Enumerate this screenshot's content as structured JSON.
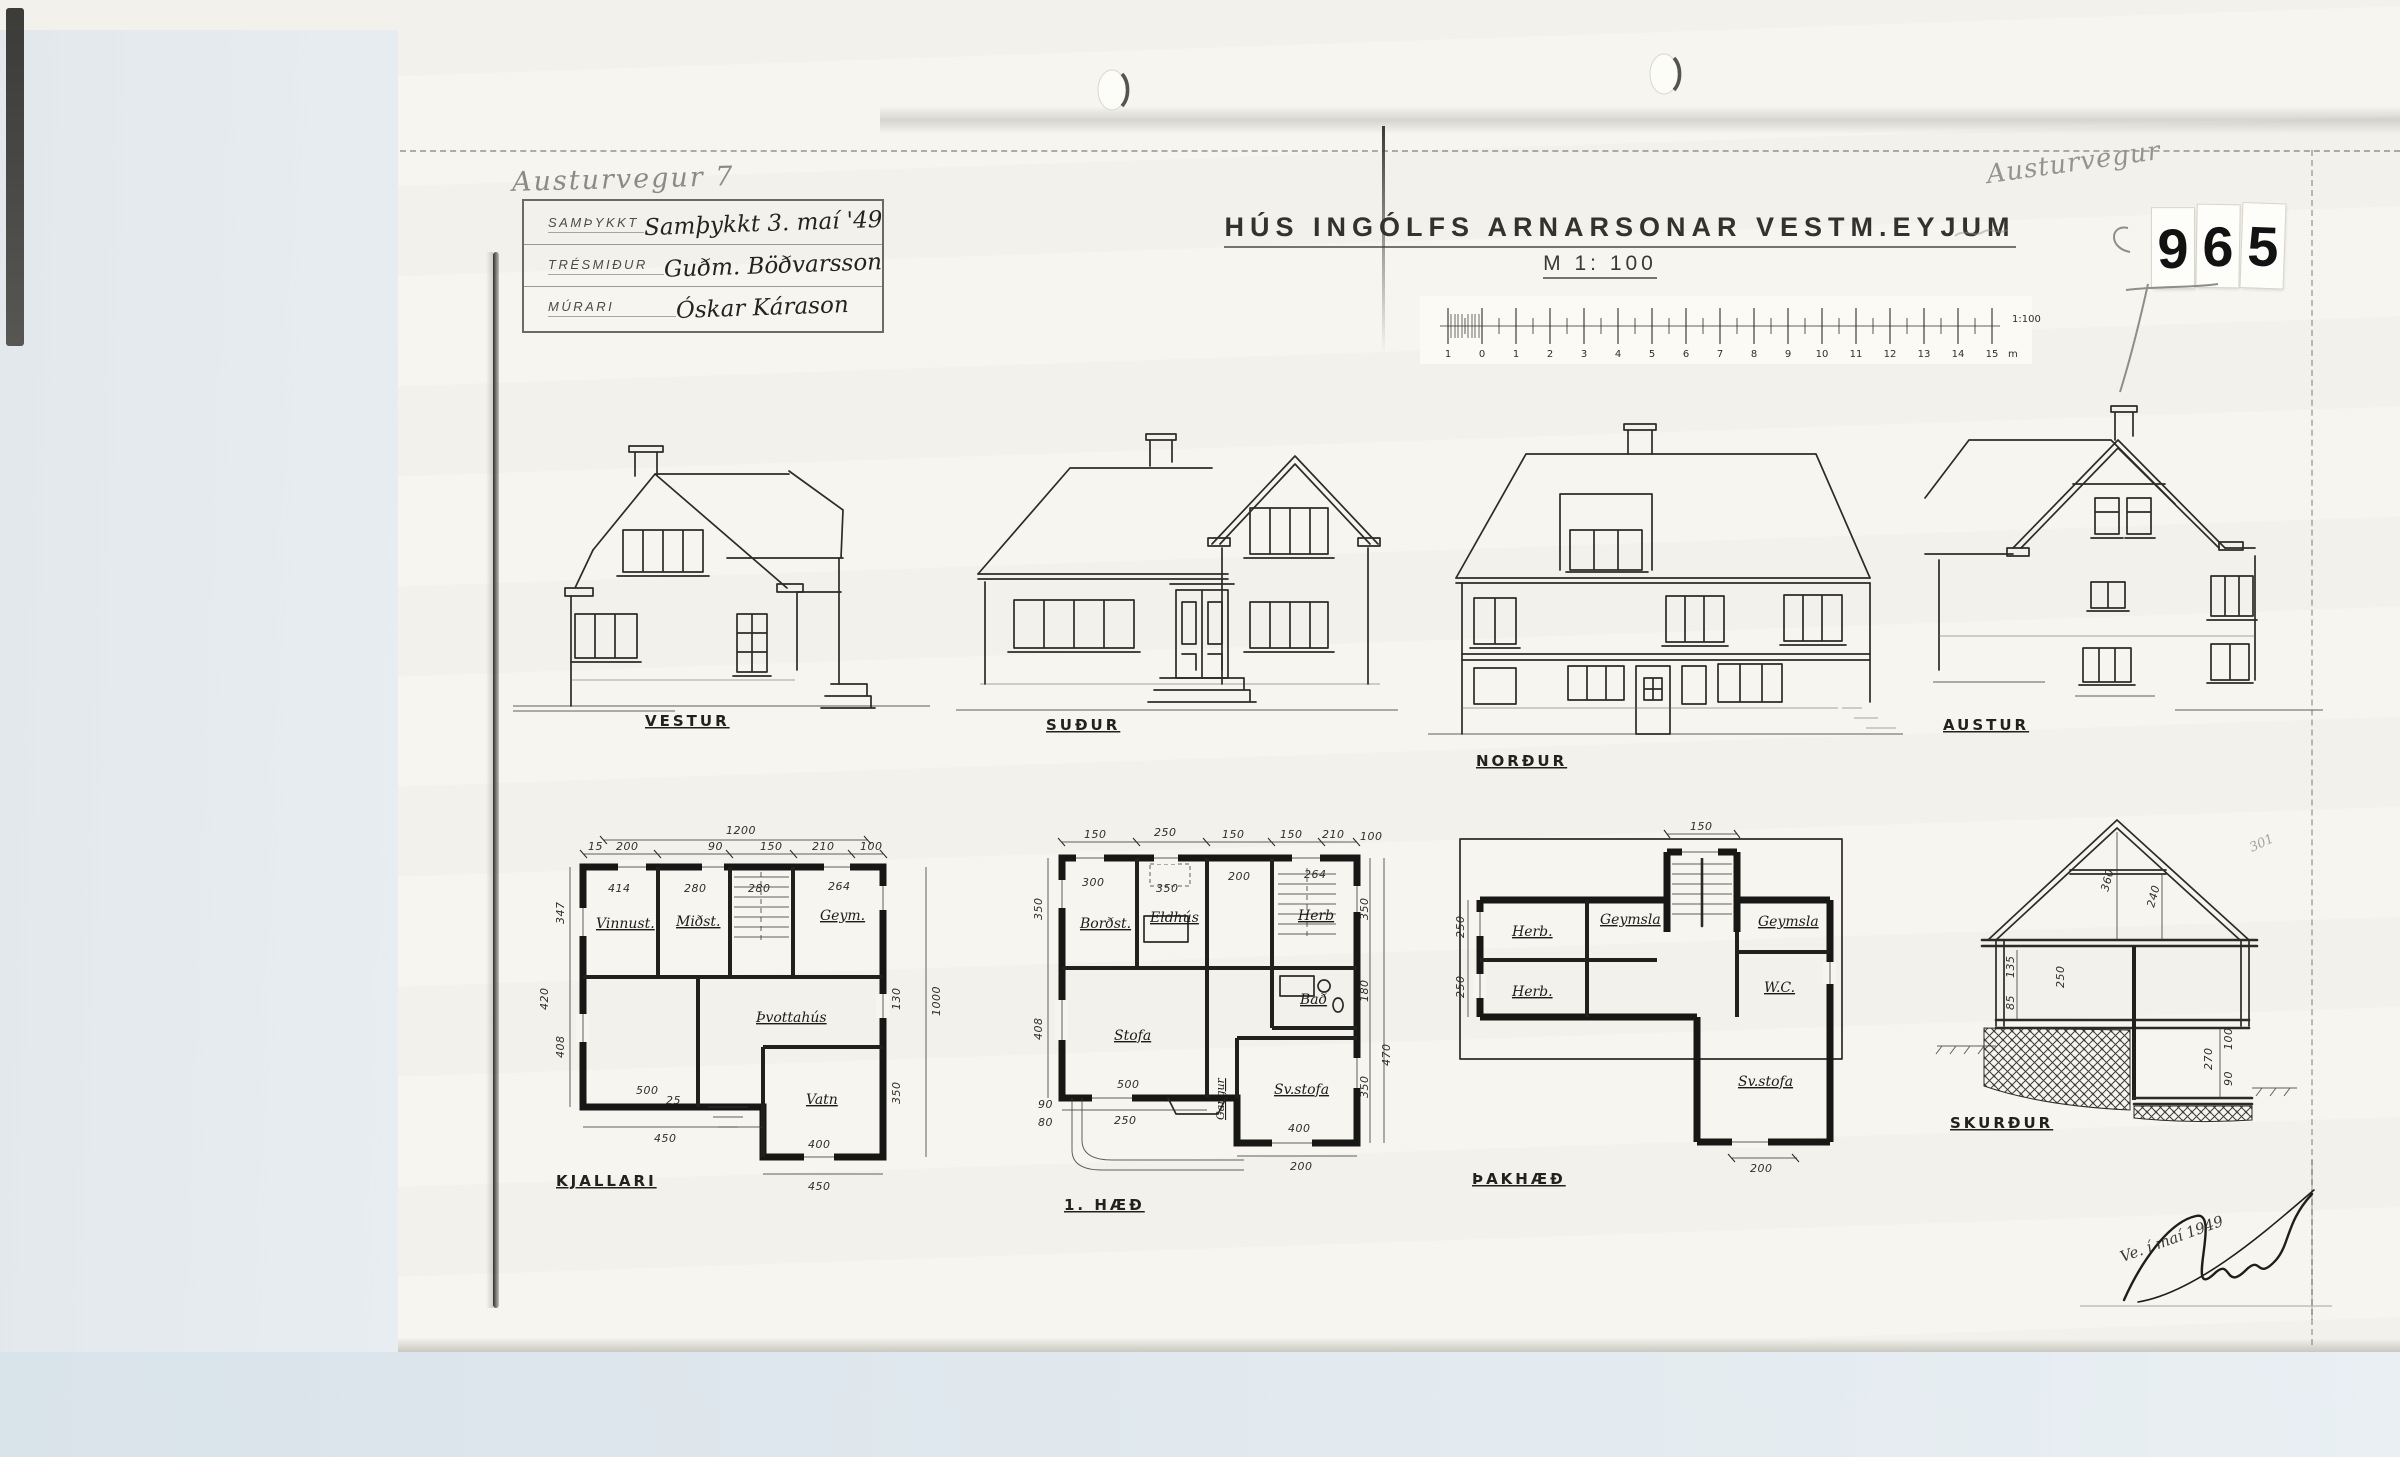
{
  "stamp": {
    "digits": [
      "9",
      "6",
      "5"
    ]
  },
  "header": {
    "pencil_address": "Austurvegur 7",
    "pencil_note": "Austurvegur",
    "title": "HÚS INGÓLFS ARNARSONAR VESTM.EYJUM",
    "scale_heading": "M 1: 100",
    "scale_ratio_label": "1:100",
    "scale_unit": "m",
    "scale_ticks": [
      "1",
      "0",
      "1",
      "2",
      "3",
      "4",
      "5",
      "6",
      "7",
      "8",
      "9",
      "10",
      "11",
      "12",
      "13",
      "14",
      "15"
    ],
    "approval_table": {
      "rows": [
        {
          "label": "SAMÞYKKT",
          "value": "Samþykkt 3. maí '49"
        },
        {
          "label": "TRÉSMIÐUR",
          "value": "Guðm. Böðvarsson"
        },
        {
          "label": "MÚRARI",
          "value": "Óskar Kárason"
        }
      ]
    },
    "signature": "Ve. í maí 1949"
  },
  "elevations": {
    "vestur": "VESTUR",
    "sudur": "SUÐUR",
    "nordur": "NORÐUR",
    "austur": "AUSTUR"
  },
  "plans": {
    "kjallari": {
      "label": "KJALLARI",
      "rooms": [
        "Vinnust.",
        "Miðst.",
        "Geym.",
        "Þvottahús",
        "Vatn"
      ],
      "dims": [
        "1200",
        "15",
        "200",
        "90",
        "150",
        "210",
        "100",
        "414",
        "280",
        "280",
        "264",
        "347",
        "420",
        "408",
        "500",
        "25",
        "450",
        "400",
        "450",
        "130",
        "1000",
        "350"
      ]
    },
    "haed1": {
      "label": "1. HÆÐ",
      "rooms": [
        "Borðst.",
        "Eldhús",
        "Herb",
        "Bað",
        "Stofa",
        "Sv.stofa",
        "Gangur"
      ],
      "dims": [
        "150",
        "250",
        "150",
        "150",
        "210",
        "100",
        "300",
        "350",
        "200",
        "264",
        "350",
        "408",
        "90",
        "80",
        "500",
        "250",
        "400",
        "200",
        "350",
        "180",
        "470",
        "350"
      ]
    },
    "thakhaed": {
      "label": "ÞAKHÆÐ",
      "rooms": [
        "Herb.",
        "Herb.",
        "Geymsla",
        "Geymsla",
        "W.C.",
        "Sv.stofa"
      ],
      "dims": [
        "150",
        "250",
        "250",
        "200"
      ]
    },
    "skurdur": {
      "label": "SKURÐUR",
      "dims": [
        "360",
        "240",
        "250",
        "135",
        "85",
        "270",
        "90",
        "100"
      ],
      "pencil_note": "301"
    }
  }
}
